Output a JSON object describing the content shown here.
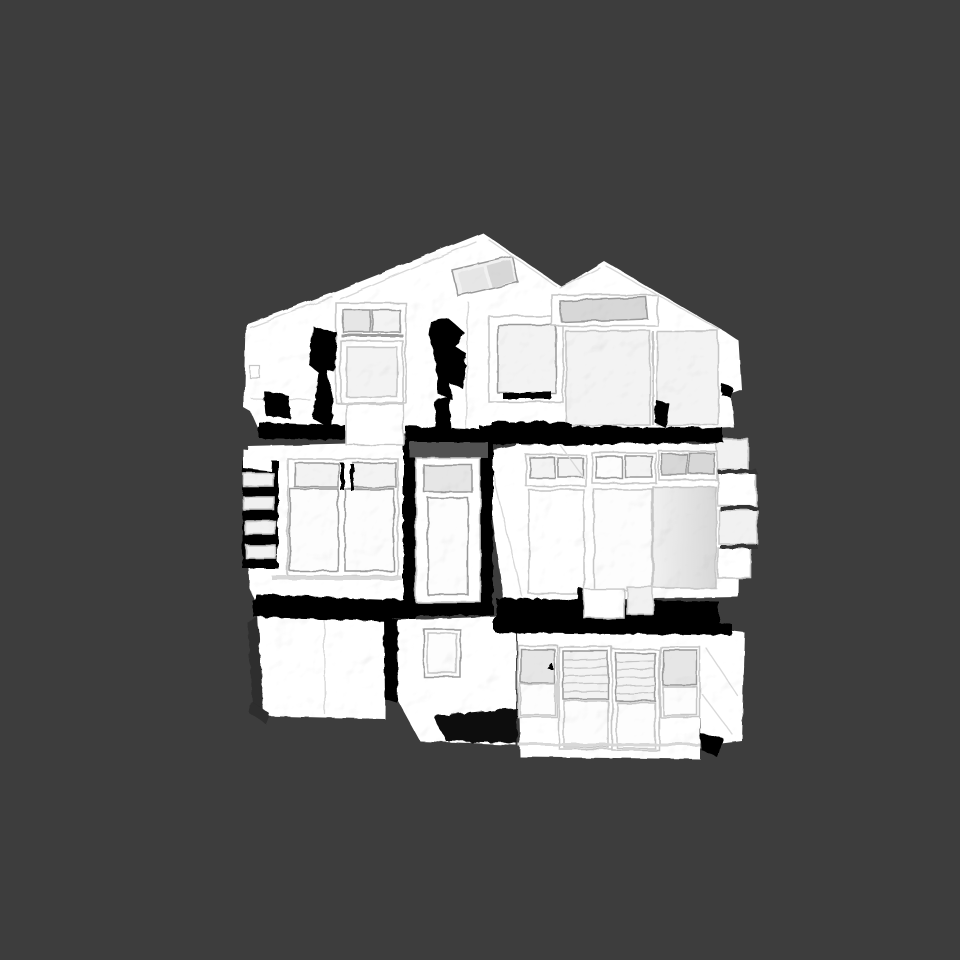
{
  "scene": {
    "description": "Untextured white 3D photogrammetry scan mesh of a multi-story house facade shown front-on in an empty 3D viewport. Crumpled white surfaces, gray glass panes, and black holes/shadow gaps where the scan has no data. No text, toolbars or UI chrome visible.",
    "object_label": "house-facade-scan-mesh",
    "view": "front elevation",
    "viewport": {
      "width_px": 960,
      "height_px": 960
    },
    "colors": {
      "bg": "#3d3d3d",
      "mesh": "#ffffff",
      "mesh_dim": "#f1f1f1",
      "pane": "#f3f3f3",
      "pane_bright": "#fdfdfd",
      "pane_gray": "#e6e6e6",
      "transom_gray": "#d7d7d7",
      "band_gray": "#515151",
      "frame_line": "#9a9a9a",
      "soft_line": "#c6c6c6",
      "crease_line": "#d8d8d8",
      "hole": "#000000",
      "dark_shade": "#2d2d2d",
      "sheen_from": "#f0f0f0",
      "sheen_to": "#d8d8d8"
    },
    "parts": [
      "main-gable-roof",
      "secondary-gable-roof",
      "roof-skylight",
      "upper-left-wing",
      "upper-dormer-window",
      "upper-right-framed-window",
      "upper-right-gray-transom",
      "upper-right-glass-panels",
      "mid-left-window-unit",
      "left-louver-slats",
      "mid-center-door",
      "mid-right-storefront-band",
      "right-protruding-blocks",
      "lower-left-box",
      "lower-mid-wall-window",
      "lower-storefront-doors",
      "scan-holes-and-shadow-gaps"
    ]
  }
}
